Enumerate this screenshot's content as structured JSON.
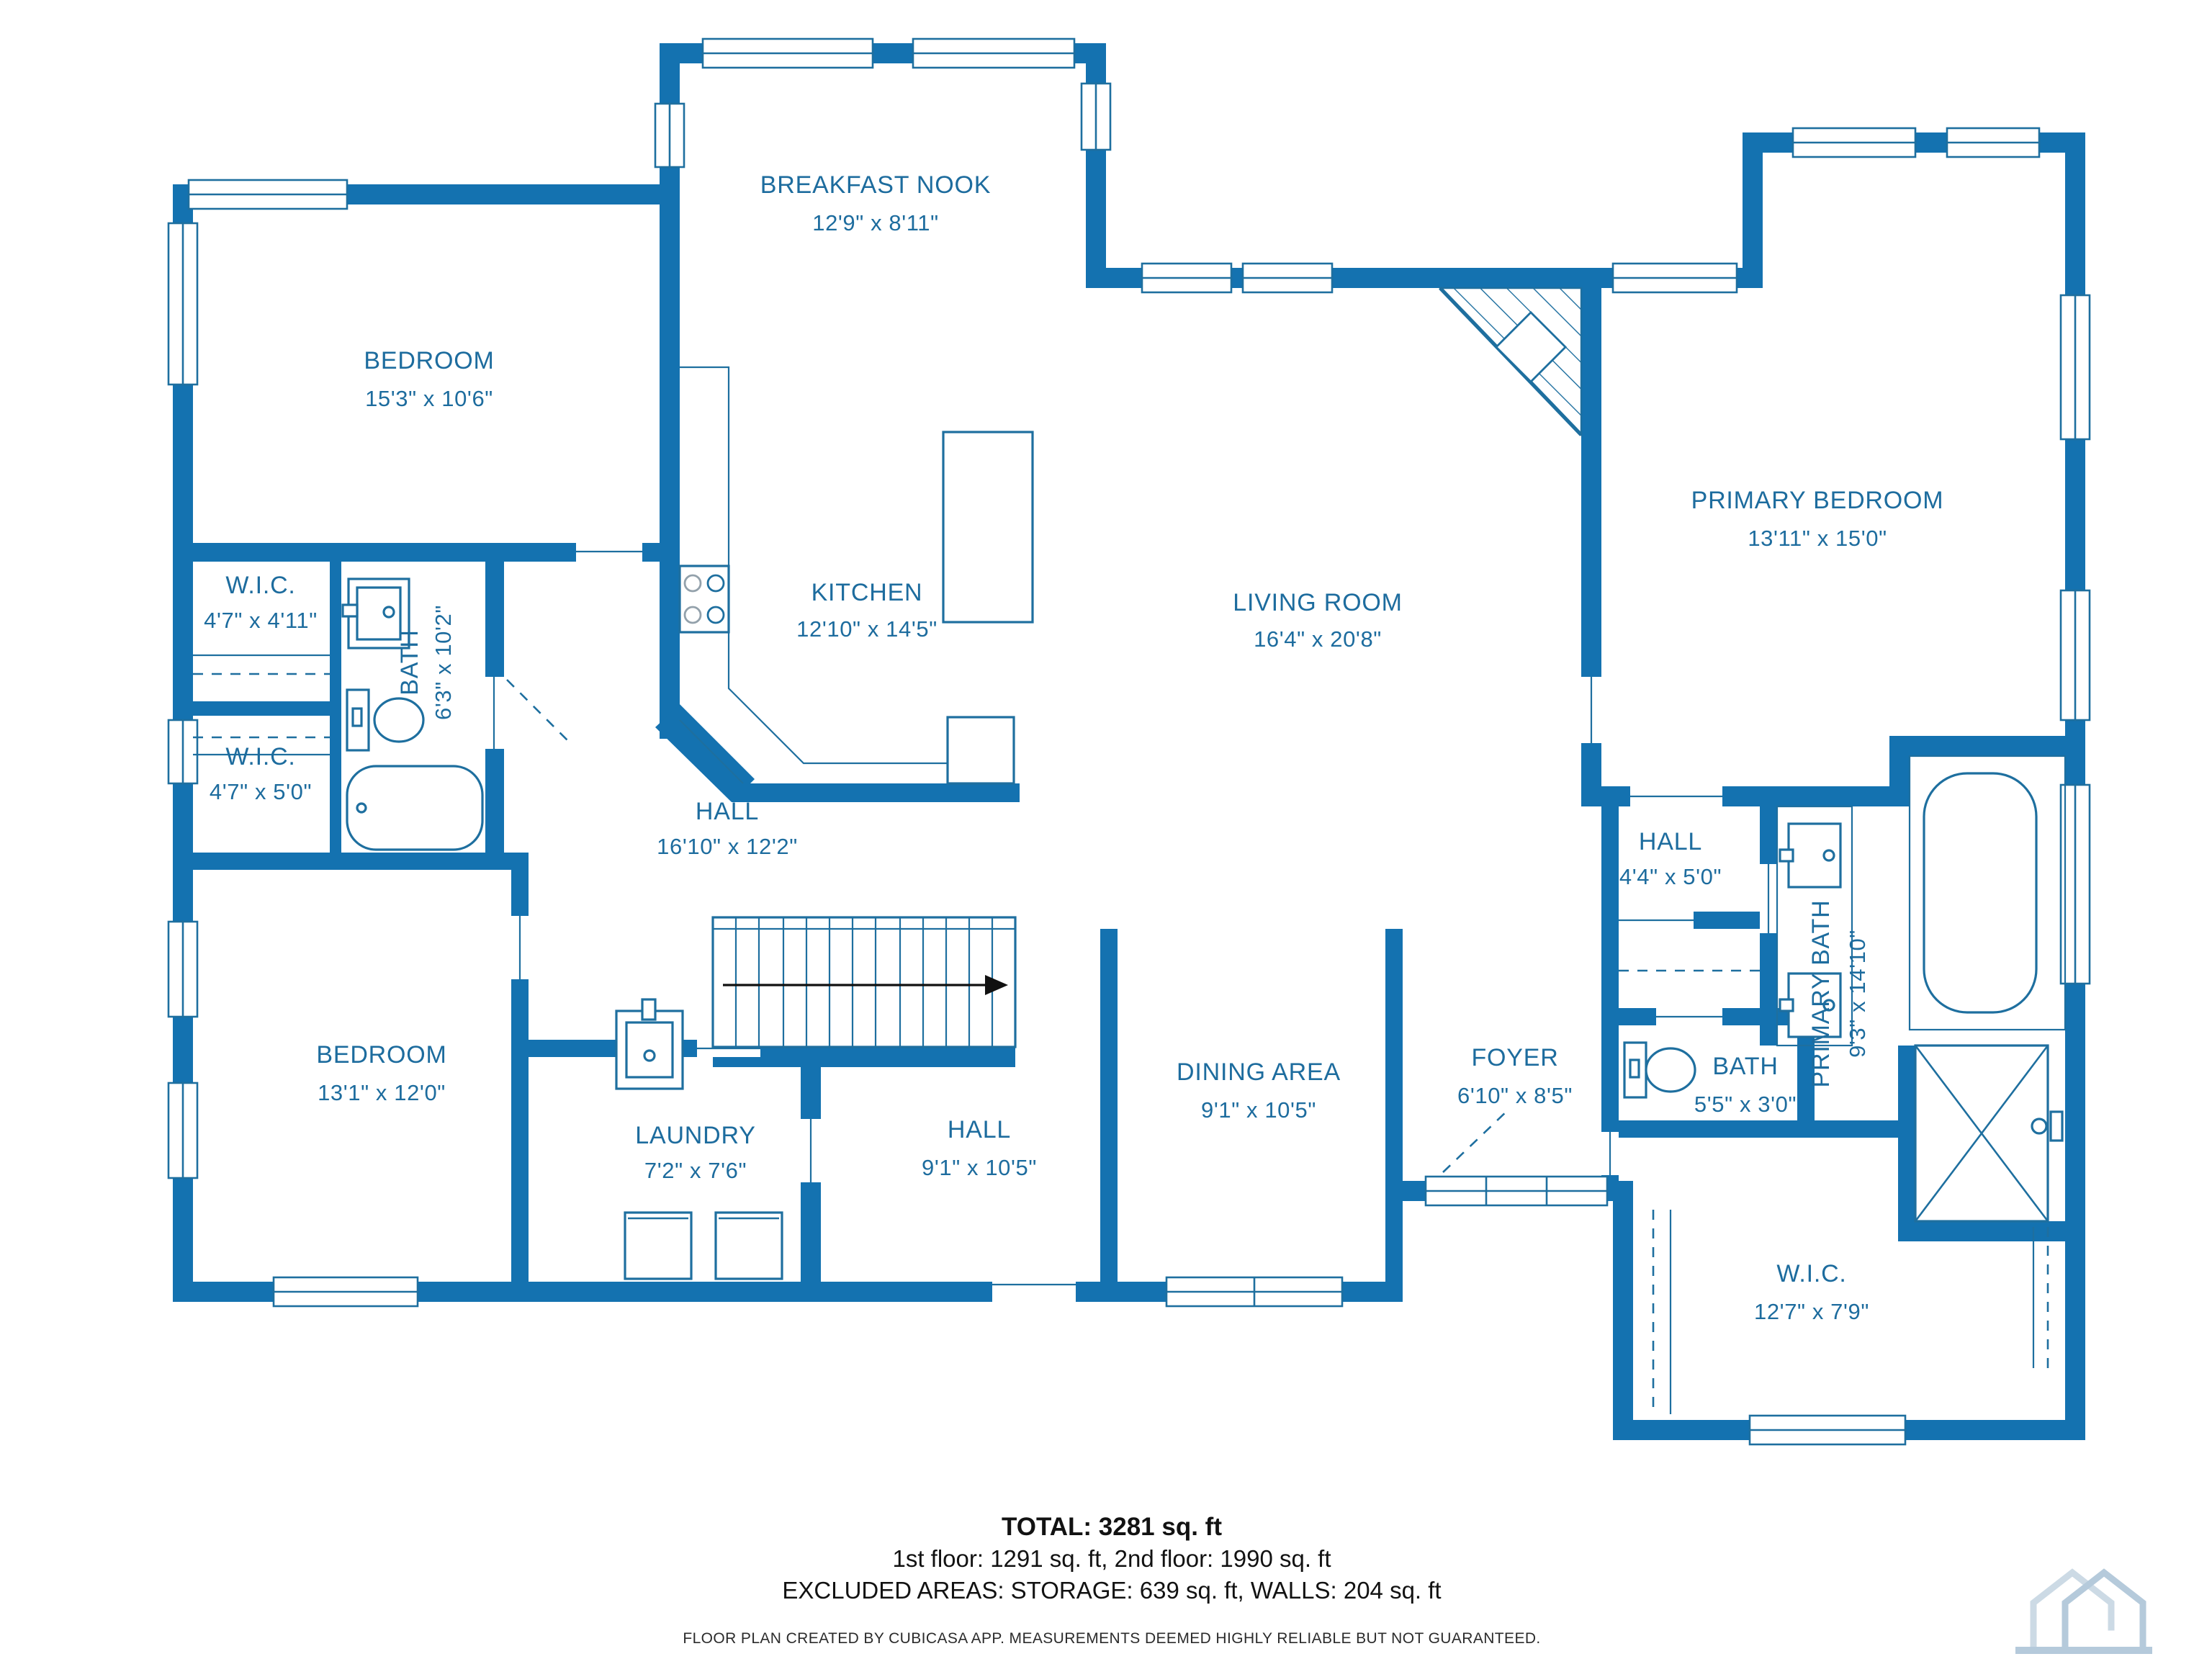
{
  "plan": {
    "wall_color": "#1472b0",
    "line_color": "#1e6f9f",
    "label_color": "#1d6c9e",
    "rooms": {
      "breakfast_nook": {
        "name": "BREAKFAST NOOK",
        "dims": "12'9\" x 8'11\""
      },
      "bedroom_upper": {
        "name": "BEDROOM",
        "dims": "15'3\" x 10'6\""
      },
      "wic_upper": {
        "name": "W.I.C.",
        "dims": "4'7\" x 4'11\""
      },
      "bath_hall": {
        "name": "BATH",
        "dims": "6'3\" x 10'2\""
      },
      "wic_lower": {
        "name": "W.I.C.",
        "dims": "4'7\" x 5'0\""
      },
      "kitchen": {
        "name": "KITCHEN",
        "dims": "12'10\" x 14'5\""
      },
      "living_room": {
        "name": "LIVING ROOM",
        "dims": "16'4\" x 20'8\""
      },
      "primary_bedroom": {
        "name": "PRIMARY BEDROOM",
        "dims": "13'11\" x 15'0\""
      },
      "hall_center": {
        "name": "HALL",
        "dims": "16'10\" x 12'2\""
      },
      "hall_primary": {
        "name": "HALL",
        "dims": "4'4\" x 5'0\""
      },
      "primary_bath": {
        "name": "PRIMARY BATH",
        "dims": "9'3\" x 14'10\""
      },
      "bedroom_lower": {
        "name": "BEDROOM",
        "dims": "13'1\" x 12'0\""
      },
      "laundry": {
        "name": "LAUNDRY",
        "dims": "7'2\" x 7'6\""
      },
      "hall_lower": {
        "name": "HALL",
        "dims": "9'1\" x 10'5\""
      },
      "dining_area": {
        "name": "DINING AREA",
        "dims": "9'1\" x 10'5\""
      },
      "foyer": {
        "name": "FOYER",
        "dims": "6'10\" x 8'5\""
      },
      "bath_small": {
        "name": "BATH",
        "dims": "5'5\" x 3'0\""
      },
      "wic_primary": {
        "name": "W.I.C.",
        "dims": "12'7\" x 7'9\""
      }
    },
    "summary": {
      "total": "TOTAL: 3281 sq. ft",
      "floors": "1st floor: 1291 sq. ft, 2nd floor: 1990 sq. ft",
      "excluded": "EXCLUDED AREAS: STORAGE: 639 sq. ft, WALLS: 204 sq. ft",
      "disclaimer": "FLOOR PLAN CREATED BY CUBICASA APP. MEASUREMENTS DEEMED HIGHLY RELIABLE BUT NOT GUARANTEED."
    }
  }
}
